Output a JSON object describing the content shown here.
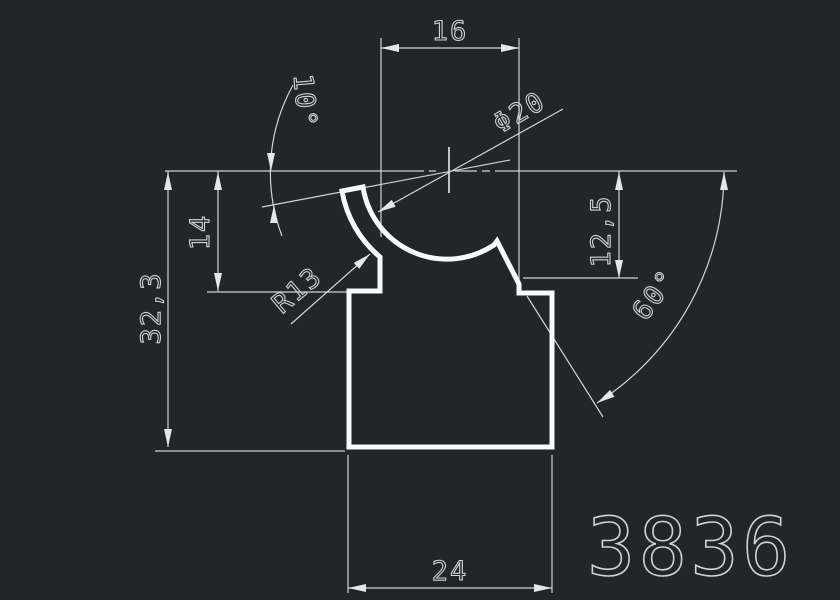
{
  "canvas": {
    "background": "#21262b",
    "line_color": "#cfd4d8",
    "profile_color": "#f7f8f9",
    "text_color": "#ced3d7",
    "arrow_color": "#e4e7ea"
  },
  "dimensions": {
    "top_width": "16",
    "diameter": "Φ20",
    "tip_angle": "10°",
    "left_inner_height": "14",
    "total_height": "32,3",
    "right_depth": "12,5",
    "radius": "R13",
    "slant_angle": "60°",
    "bottom_width": "24"
  },
  "part_number": "3836"
}
